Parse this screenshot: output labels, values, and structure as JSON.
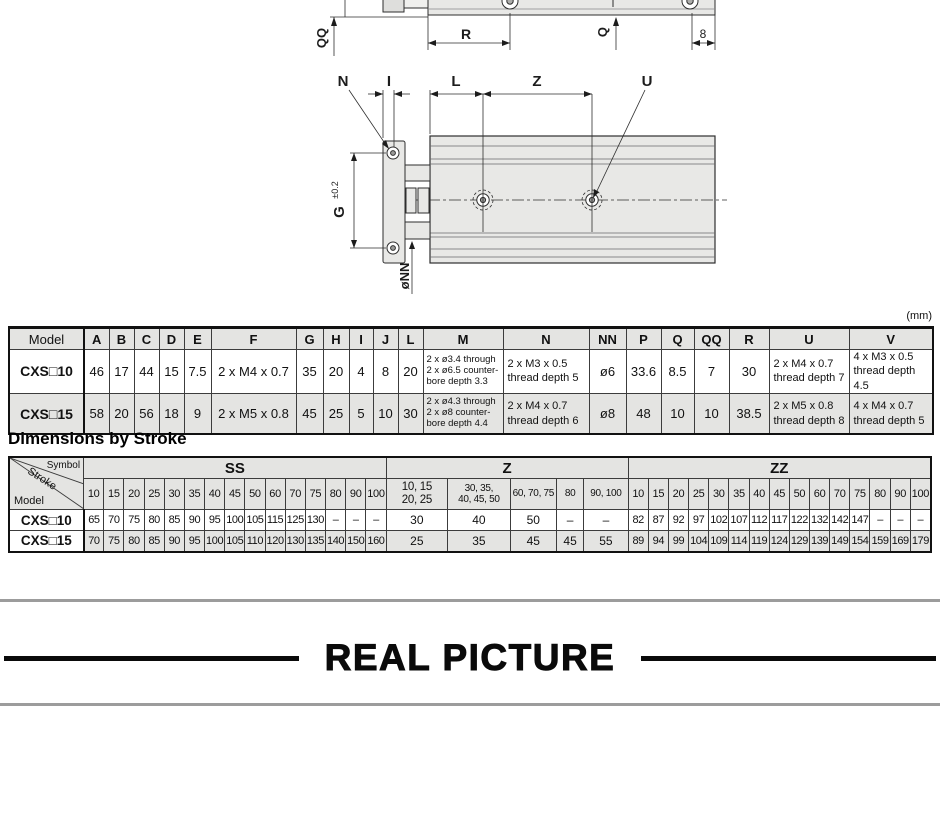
{
  "d": {
    "qq": "QQ",
    "r": "R",
    "q": "Q",
    "n8": "8",
    "n": "N",
    "i": "I",
    "l": "L",
    "z": "Z",
    "u": "U",
    "g": "G",
    "gtol": "±0.2",
    "onn": "øNN"
  },
  "t1": {
    "unit": "(mm)",
    "h": [
      "Model",
      "A",
      "B",
      "C",
      "D",
      "E",
      "F",
      "G",
      "H",
      "I",
      "J",
      "L",
      "M",
      "N",
      "NN",
      "P",
      "Q",
      "QQ",
      "R",
      "U",
      "V"
    ],
    "r0": [
      "CXS□10",
      "46",
      "17",
      "44",
      "15",
      "7.5",
      "2 x M4 x 0.7",
      "35",
      "20",
      "4",
      "8",
      "20",
      "2 x ø3.4 through\n2 x ø6.5 counter-\nbore depth 3.3",
      "2 x M3 x 0.5\nthread depth 5",
      "ø6",
      "33.6",
      "8.5",
      "7",
      "30",
      "2 x M4 x 0.7\nthread depth 7",
      "4 x M3 x 0.5\nthread depth 4.5"
    ],
    "r1": [
      "CXS□15",
      "58",
      "20",
      "56",
      "18",
      "9",
      "2 x M5 x 0.8",
      "45",
      "25",
      "5",
      "10",
      "30",
      "2 x ø4.3 through\n2 x ø8 counter-\nbore depth 4.4",
      "2 x M4 x 0.7\nthread depth 6",
      "ø8",
      "48",
      "10",
      "10",
      "38.5",
      "2 x M5 x 0.8\nthread depth 8",
      "4 x M4 x 0.7\nthread depth 5"
    ]
  },
  "t2": {
    "title": "Dimensions by Stroke",
    "corner": {
      "symbol": "Symbol",
      "stroke": "Stroke",
      "model": "Model"
    },
    "g": [
      "SS",
      "Z",
      "ZZ"
    ],
    "ss": [
      "10",
      "15",
      "20",
      "25",
      "30",
      "35",
      "40",
      "45",
      "50",
      "60",
      "70",
      "75",
      "80",
      "90",
      "100"
    ],
    "zh": [
      "10, 15\n20, 25",
      "30, 35,\n40, 45, 50",
      "60, 70, 75",
      "80",
      "90, 100"
    ],
    "zz": [
      "10",
      "15",
      "20",
      "25",
      "30",
      "35",
      "40",
      "45",
      "50",
      "60",
      "70",
      "75",
      "80",
      "90",
      "100"
    ],
    "r0": {
      "model": "CXS□10",
      "ss": [
        "65",
        "70",
        "75",
        "80",
        "85",
        "90",
        "95",
        "100",
        "105",
        "115",
        "125",
        "130",
        "–",
        "–",
        "–"
      ],
      "z": [
        "30",
        "40",
        "50",
        "–",
        "–"
      ],
      "zz": [
        "82",
        "87",
        "92",
        "97",
        "102",
        "107",
        "112",
        "117",
        "122",
        "132",
        "142",
        "147",
        "–",
        "–",
        "–"
      ]
    },
    "r1": {
      "model": "CXS□15",
      "ss": [
        "70",
        "75",
        "80",
        "85",
        "90",
        "95",
        "100",
        "105",
        "110",
        "120",
        "130",
        "135",
        "140",
        "150",
        "160"
      ],
      "z": [
        "25",
        "35",
        "45",
        "45",
        "55"
      ],
      "zz": [
        "89",
        "94",
        "99",
        "104",
        "109",
        "114",
        "119",
        "124",
        "129",
        "139",
        "149",
        "154",
        "159",
        "169",
        "179"
      ]
    }
  },
  "footer": {
    "heading": "REAL PICTURE"
  }
}
